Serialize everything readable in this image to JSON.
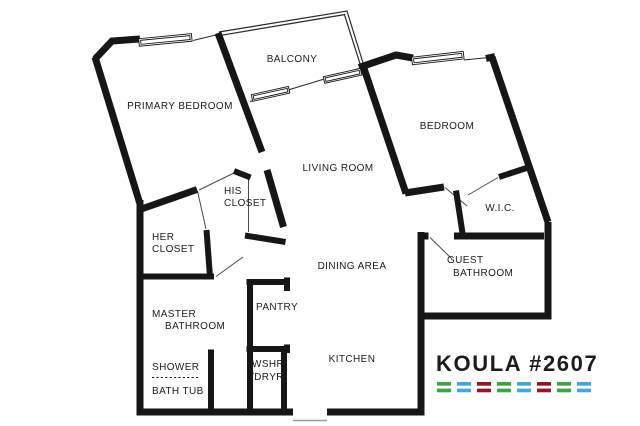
{
  "plan": {
    "title": "KOULA #2607 floor plan"
  },
  "rooms": {
    "balcony": "BALCONY",
    "primary_bedroom": "PRIMARY BEDROOM",
    "bedroom": "BEDROOM",
    "living_room": "LIVING ROOM",
    "dining_area": "DINING AREA",
    "kitchen": "KITCHEN",
    "wic": "W.I.C.",
    "guest_bathroom_line1": "GUEST",
    "guest_bathroom_line2": "BATHROOM",
    "his_closet_line1": "HIS",
    "his_closet_line2": "CLOSET",
    "her_closet_line1": "HER",
    "her_closet_line2": "CLOSET",
    "master_bathroom_line1": "MASTER",
    "master_bathroom_line2": "BATHROOM",
    "shower": "SHOWER",
    "bath_tub": "BATH TUB",
    "pantry": "PANTRY",
    "washer_dryer_line1": "WSHR",
    "washer_dryer_line2": "/DRYR"
  },
  "logo": {
    "text": "KOULA  #2607",
    "color": "#8c1b27",
    "dash_colors": [
      "#43a24c",
      "#4aa4d8",
      "#8c1b27",
      "#43a24c",
      "#4aa4d8",
      "#8c1b27",
      "#43a24c",
      "#4aa4d8"
    ]
  },
  "colors": {
    "wall": "#161616",
    "background": "#ffffff"
  }
}
